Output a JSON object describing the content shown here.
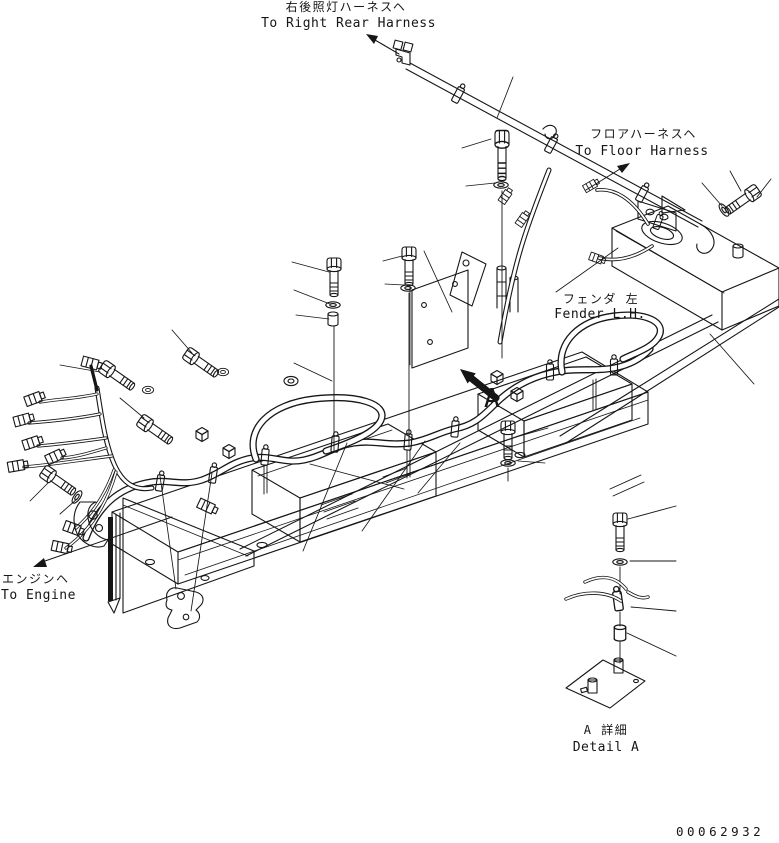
{
  "drawing": {
    "background": "#ffffff",
    "line_color": "#161616",
    "type": "parts-diagram-wiring-harness"
  },
  "labels": {
    "right_rear_harness": {
      "jp": "右後照灯ハーネスヘ",
      "en": "To Right Rear Harness"
    },
    "floor_harness": {
      "jp": "フロアハーネスヘ",
      "en": "To Floor Harness"
    },
    "fender": {
      "jp": "フェンダ 左",
      "en": "Fender L.H."
    },
    "engine": {
      "jp": "エンジンヘ",
      "en": "To Engine"
    },
    "detail": {
      "jp": "A 詳細",
      "en": "Detail A"
    },
    "section_marker": "A",
    "drawing_number": "00062932"
  }
}
